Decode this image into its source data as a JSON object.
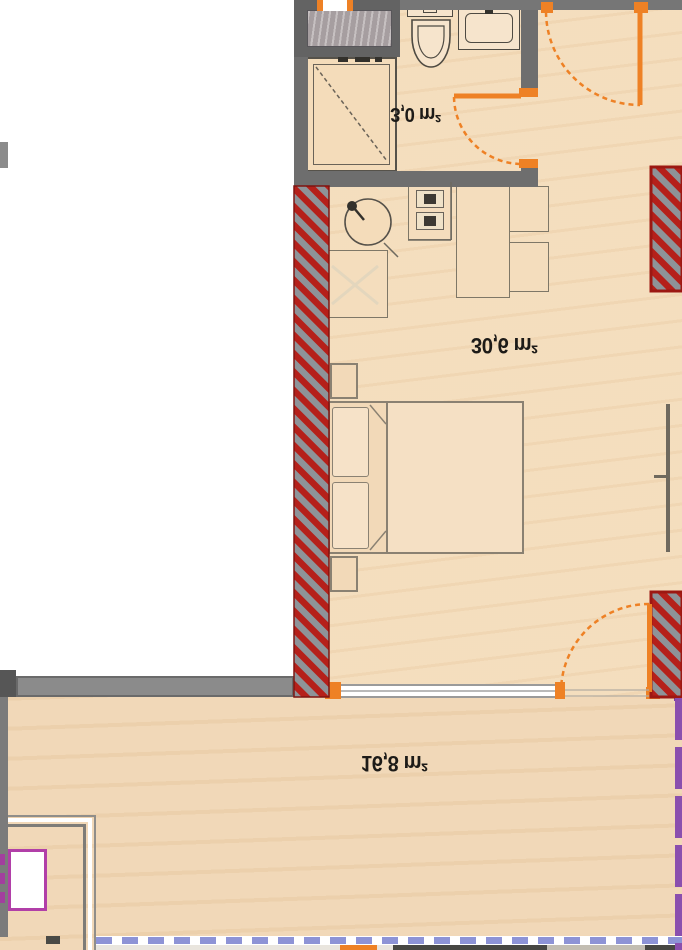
{
  "rooms": {
    "bathroom": {
      "area_label": "3,0 m²"
    },
    "living_room": {
      "area_label": "30,6 m²"
    },
    "terrace": {
      "area_label": "16,8 m²"
    }
  },
  "colors": {
    "floor": "#f4dcba",
    "terrace_floor": "#f0d6b4",
    "wall_gray": "#6e6e6e",
    "insulation_stripe_red": "#b5201a",
    "insulation_gray": "#8e9398",
    "door_window_orange": "#ee8125",
    "railing_periwinkle": "#8d93d6",
    "railing_purple": "#8a4fae",
    "planter_magenta": "#b13fa8",
    "label_text": "#1d1b18"
  },
  "fixtures": {
    "bathroom": [
      "washing-machine-icon",
      "shower-icon",
      "toilet-icon",
      "sink-icon",
      "door-swing-icon",
      "window-icon"
    ],
    "kitchen": [
      "kitchen-sink-icon",
      "stove-icon",
      "cabinet-icon"
    ],
    "living_room": [
      "dining-table-icon",
      "chair-icon",
      "double-bed-icon",
      "pillow-icon",
      "nightstand-icon",
      "wall-tv-icon",
      "entrance-door-swing-icon",
      "terrace-door-swing-icon",
      "window-band-icon"
    ],
    "terrace": [
      "railing-dashed-icon",
      "planter-icon"
    ]
  }
}
